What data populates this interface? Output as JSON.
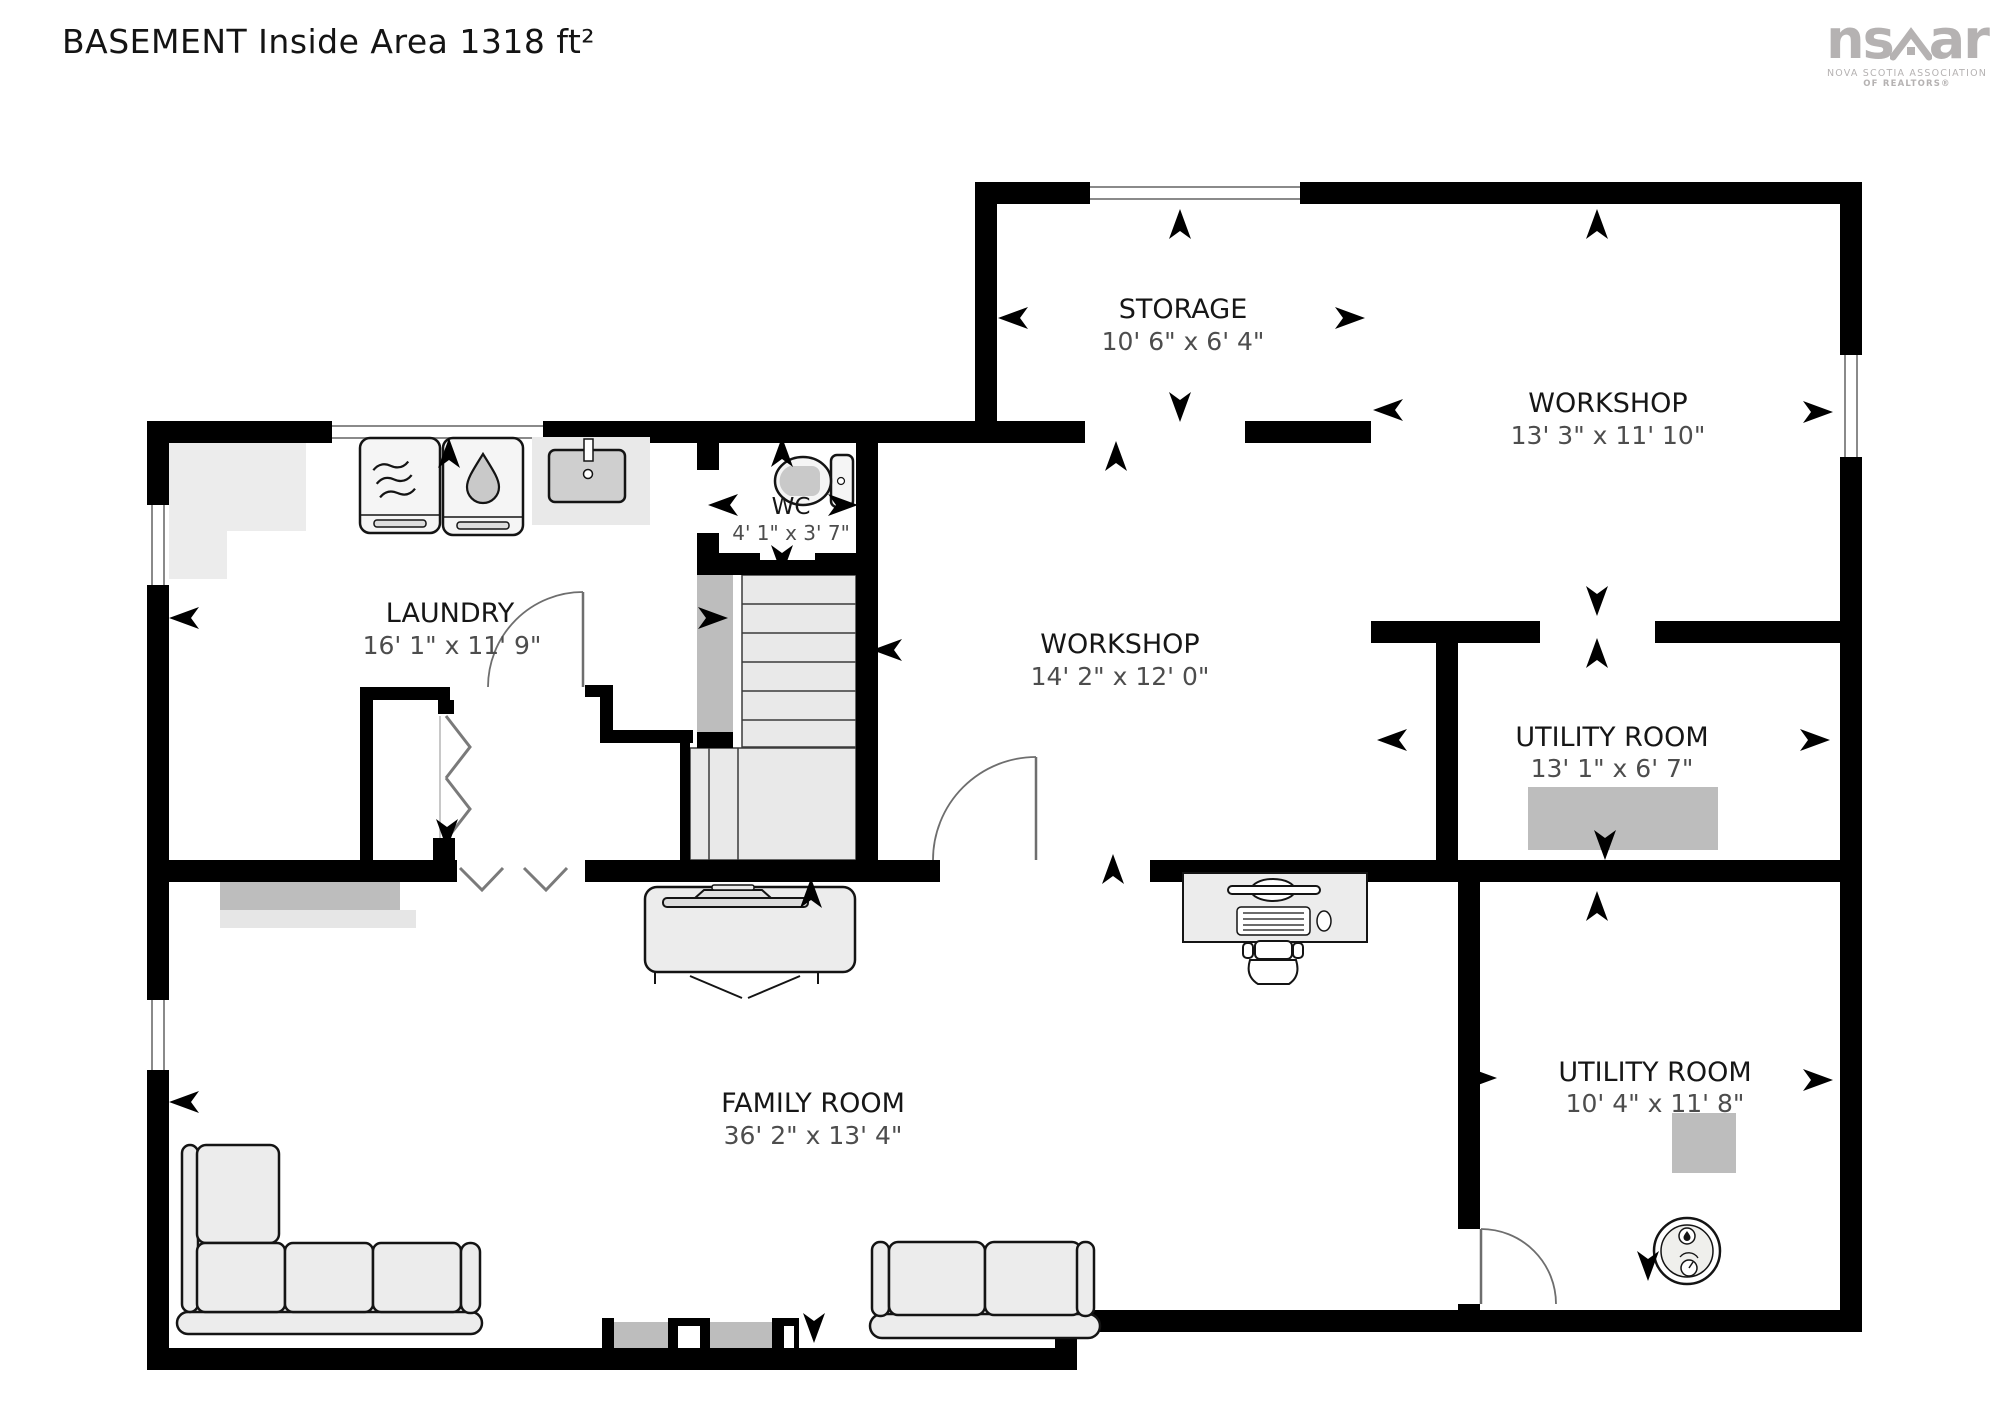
{
  "title": "BASEMENT Inside Area 1318 ft²",
  "logo": {
    "ns": "ns",
    "ar": "ar",
    "sub1": "NOVA SCOTIA ASSOCIATION",
    "sub2": "OF REALTORS®"
  },
  "rooms": [
    {
      "name": "STORAGE",
      "dims": "10' 6\" x 6' 4\""
    },
    {
      "name": "WORKSHOP",
      "dims": "13' 3\" x 11' 10\""
    },
    {
      "name": "LAUNDRY",
      "dims": "16' 1\" x 11' 9\""
    },
    {
      "name": "WC",
      "dims": "4' 1\" x 3' 7\""
    },
    {
      "name": "WORKSHOP",
      "dims": "14' 2\" x 12' 0\""
    },
    {
      "name": "UTILITY ROOM",
      "dims": "13' 1\" x 6' 7\""
    },
    {
      "name": "UTILITY ROOM",
      "dims": "10' 4\" x 11' 8\""
    },
    {
      "name": "FAMILY ROOM",
      "dims": "36' 2\" x 13' 4\""
    }
  ],
  "colors": {
    "wall": "#000000",
    "room_name": "#161616",
    "room_dims": "#4d4d4d",
    "equipment_gray": "#bdbdbd",
    "light_gray": "#ececec",
    "logo_gray": "#b5b2b2"
  }
}
